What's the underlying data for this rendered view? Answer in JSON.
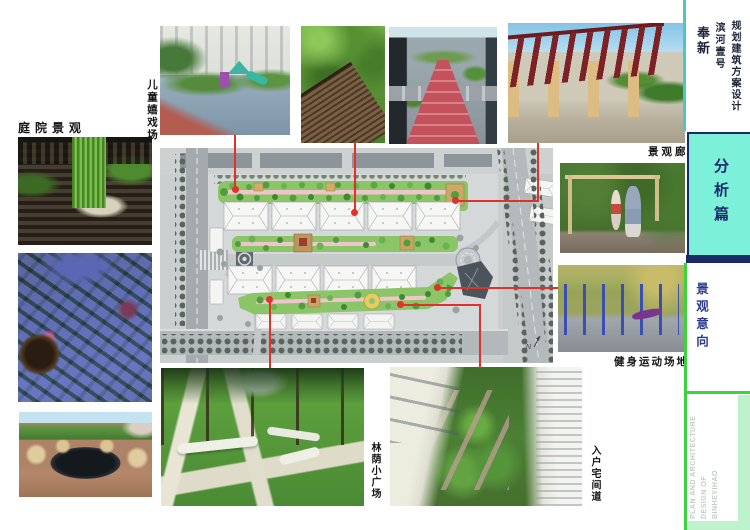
{
  "header": {
    "series_title": "规划建筑方案设计",
    "project_name": "滨河壹号",
    "location": "奉新"
  },
  "section": {
    "badge": "分析篇",
    "subtitle": "景观意向",
    "footer_lines": [
      "PLAN AND ARCHITECTURE",
      "DESIGN OF",
      "BINHEYIHAO"
    ]
  },
  "photo_labels": {
    "courtyard": "庭院景观",
    "children_playground": "儿童嬉戏场",
    "landscape_corridor": "景观廊",
    "fitness_ground": "健身运动场地",
    "shaded_plaza": "林荫小广场",
    "entry_path": "入户宅间道"
  },
  "plan": {
    "north_label": "N"
  },
  "colors": {
    "accent_cyan": "#7df0da",
    "navy": "#1b2a66",
    "bright_green": "#3bd43b",
    "pale_green": "#bef2cc",
    "connector_red": "#e2312a"
  }
}
